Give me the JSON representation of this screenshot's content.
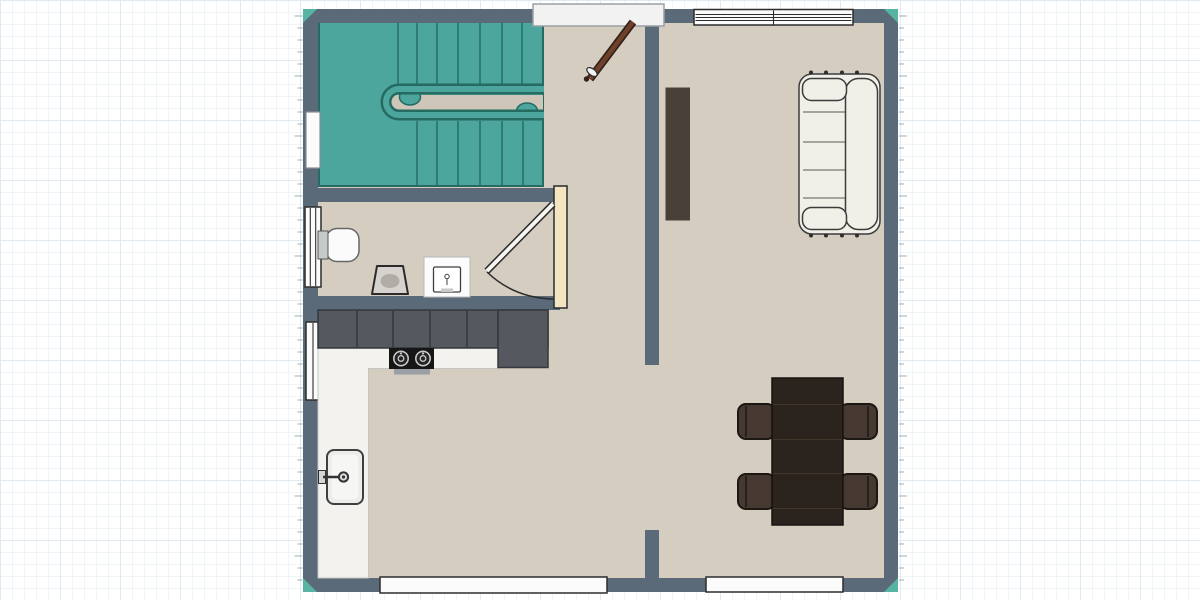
{
  "app": {
    "name": "floor-plan-editor",
    "view": "2d-top-down-floor-plan"
  },
  "colors": {
    "wall": "#5b6a79",
    "floor": "#d4cdc0",
    "floorGap": "#cdc6b9",
    "stairs": "#4ca69d",
    "stairsDark": "#256b62",
    "cornerTeal": "#57b3a2",
    "cabinet": "#55595f",
    "cabinetLine": "#35383c",
    "counter": "#f3f2ee",
    "counterEdge": "#c6c5c1",
    "cooktop": "#161616",
    "burnerRing": "#c8c8c8",
    "fixtureWhite": "#fbfbfb",
    "windowBorder": "#2d2d2d",
    "lightBorder": "#9aa0a6",
    "doorCream": "#f3e4c2",
    "doorBrown": "#6f4129",
    "doorBrownDark": "#33211a",
    "tv": "#494139",
    "sofa": "#f0efe8",
    "sofaLine": "#3c3c3c",
    "cushionLine": "#77766e",
    "table": "#2a231e",
    "tableSeam": "#44382d",
    "chair": "#453931",
    "chairDark": "#1d1713",
    "fixture": "#d6d3cf",
    "fixtureOval": "#b0ada7",
    "sinkSteel": "#ececea",
    "tank": "#c7cacb",
    "tab": "#9aa0a4",
    "tick": "#9bb0ba",
    "gridMinor": "#eef4f7",
    "gridMajor": "#e0eaf0"
  },
  "stairs": {
    "upper_steps_x": [
      398,
      417,
      437,
      458,
      480,
      502,
      522
    ],
    "lower_steps_x": [
      417,
      437,
      458,
      480,
      502,
      523
    ]
  },
  "kitchen": {
    "cabinet_divider_x": [
      357,
      393,
      430,
      467,
      498
    ]
  },
  "sofa": {
    "cushion_lines_y": [
      112,
      142,
      170,
      198
    ],
    "feet_x": [
      811,
      826,
      842,
      857
    ]
  },
  "table": {
    "seam_y": [
      404.5,
      439.5,
      473.5,
      508.5
    ]
  },
  "windows": {
    "top_right_mullion_y": [
      14.5,
      17.5,
      20.5
    ],
    "top_right_divider_x": 773.5
  },
  "ruler": {
    "start_y": 16,
    "end_y": 580,
    "minor_step": 12,
    "major_every": 60
  },
  "elements": [
    "u-shaped-staircase",
    "entry-door-open",
    "bathroom-door-with-swing",
    "wall-hung-toilet",
    "toilet",
    "washbasin",
    "kitchen-wall-cabinets",
    "tall-cabinet",
    "l-shaped-counter",
    "cooktop",
    "kitchen-sink",
    "media-sideboard",
    "sofa",
    "dining-table",
    "dining-chairs-x4",
    "stairwell-window",
    "bathroom-window",
    "kitchen-window",
    "top-right-window",
    "bottom-left-window",
    "bottom-right-window"
  ]
}
